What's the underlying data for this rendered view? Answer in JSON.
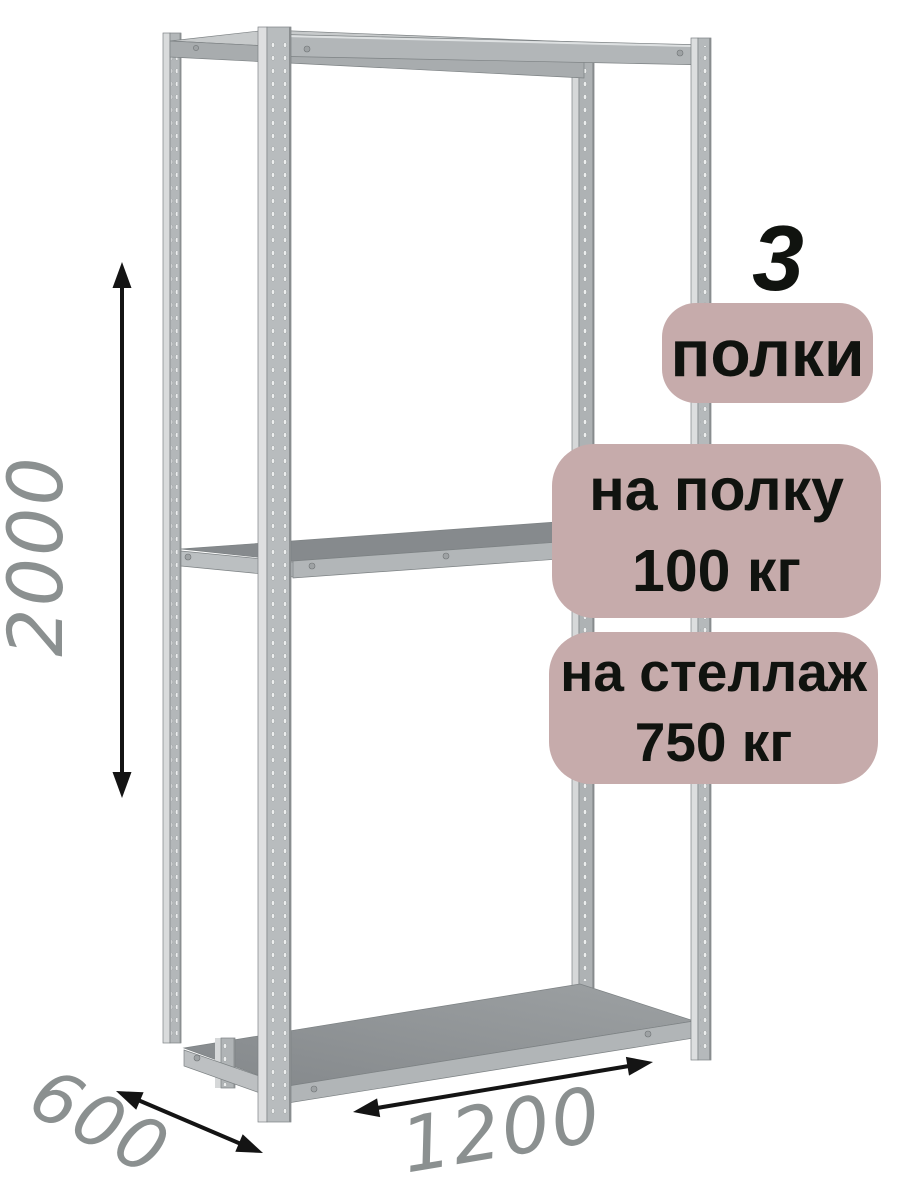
{
  "annotations": {
    "shelf_count": "3",
    "shelf_count_label": "полки",
    "shelf_load_line1": "на полку",
    "shelf_load_line2": "100 кг",
    "rack_load_line1": "на стеллаж",
    "rack_load_line2": "750 кг"
  },
  "dimensions": {
    "height_mm": "2000",
    "depth_mm": "600",
    "width_mm": "1200"
  },
  "colors": {
    "badge_bg": "#c6abab",
    "badge_text": "#10130f",
    "dimension_text": "#8b9090",
    "arrow": "#141414",
    "metal_light": "#d9dbdc",
    "metal_mid": "#b3b7b9",
    "metal_edge": "#8b8f91",
    "shelf_surface": "#8b8f91"
  }
}
